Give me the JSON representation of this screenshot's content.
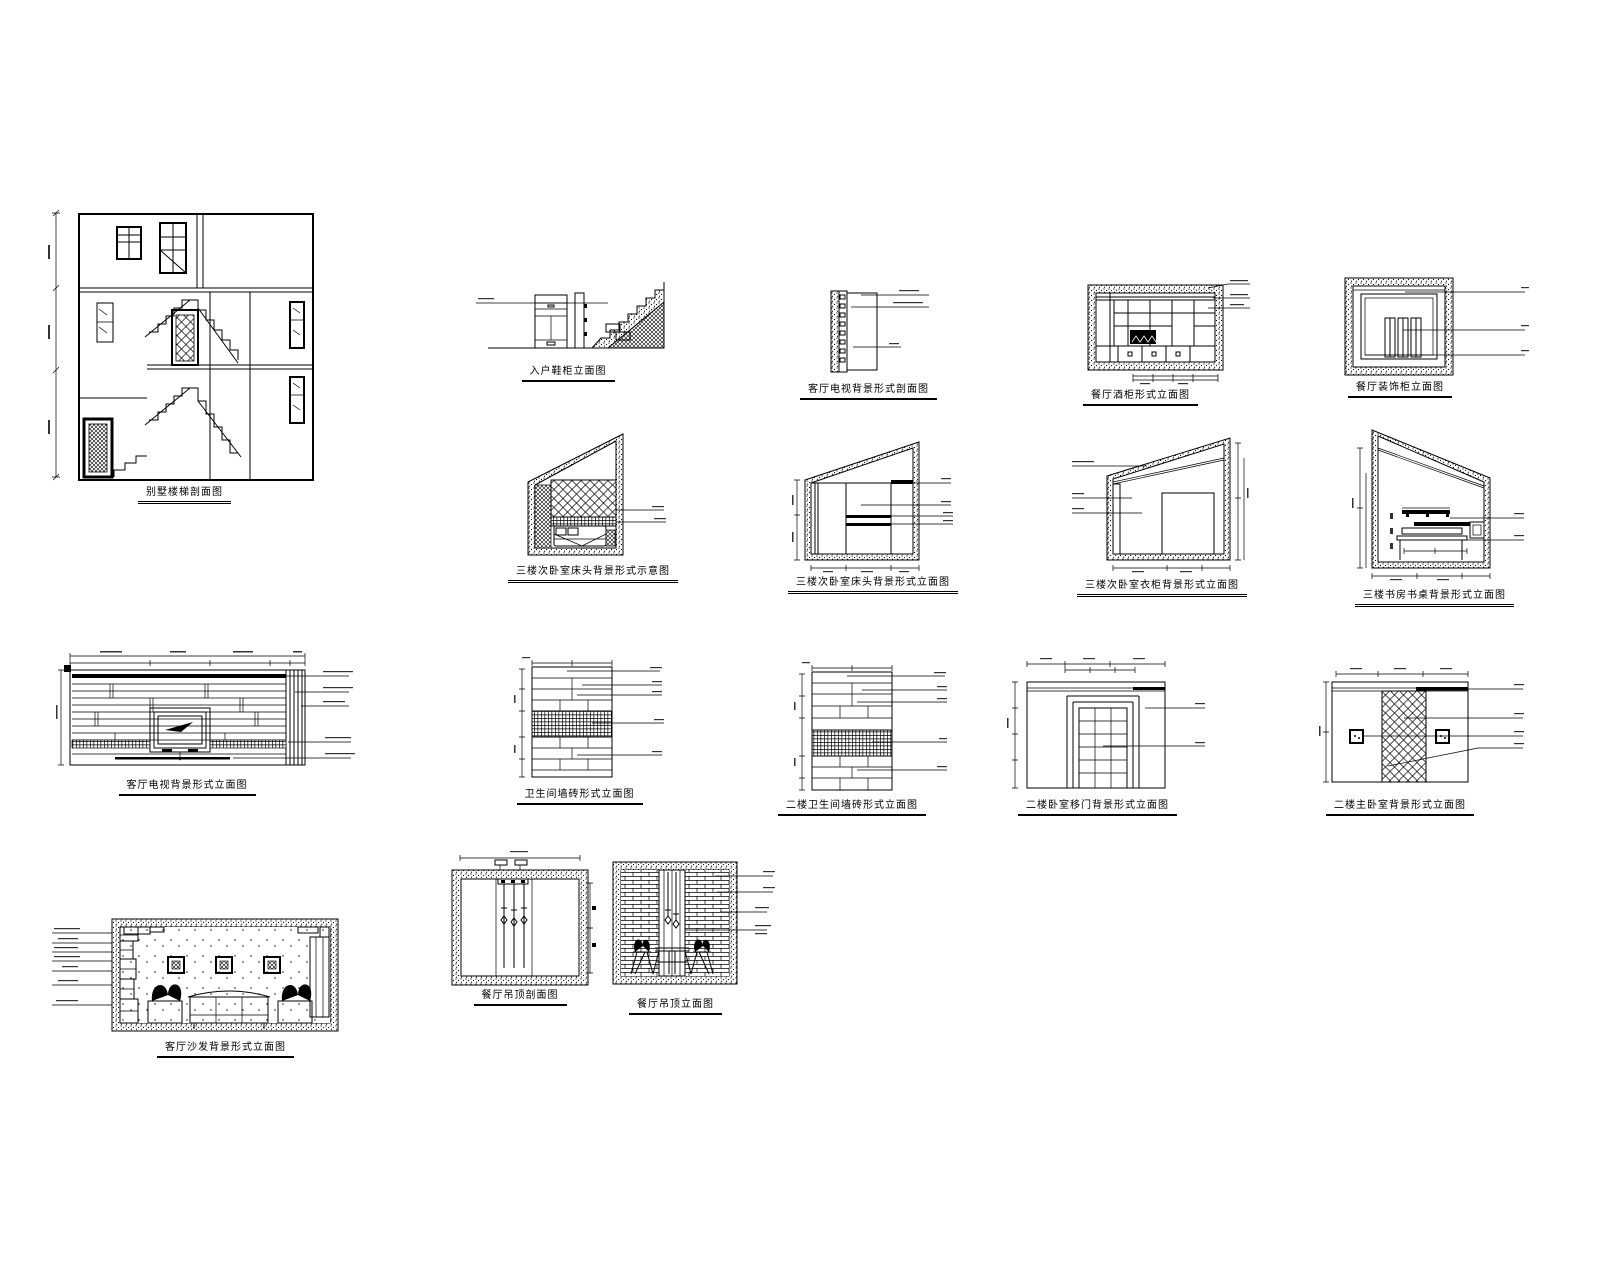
{
  "sheet": {
    "background": "#ffffff",
    "ink": "#000000",
    "description": "CAD interior design elevation sheet"
  },
  "figures": {
    "stair_section": {
      "caption": "别墅楼梯剖面图"
    },
    "entry_cabinet": {
      "caption": "入户鞋柜立面图"
    },
    "tv_wall_section": {
      "caption": "客厅电视背景形式剖面图"
    },
    "wine_cabinet": {
      "caption": "餐厅酒柜形式立面图"
    },
    "deco_cabinet": {
      "caption": "餐厅装饰柜立面图"
    },
    "attic_headboard_sketch": {
      "caption": "三楼次卧室床头背景形式示意图"
    },
    "attic_headboard": {
      "caption": "三楼次卧室床头背景形式立面图"
    },
    "attic_wardrobe": {
      "caption": "三楼次卧室衣柜背景形式立面图"
    },
    "attic_desk": {
      "caption": "三楼书房书桌背景形式立面图"
    },
    "tv_wall": {
      "caption": "客厅电视背景形式立面图"
    },
    "bath_tile_1": {
      "caption": "卫生间墙砖形式立面图"
    },
    "bath_tile_2": {
      "caption": "二楼卫生间墙砖形式立面图"
    },
    "bedroom_door": {
      "caption": "二楼卧室移门背景形式立面图"
    },
    "master_lattice": {
      "caption": "二楼主卧室背景形式立面图"
    },
    "dining_ceiling_section": {
      "caption": "餐厅吊顶剖面图"
    },
    "dining_elevation": {
      "caption": "餐厅吊顶立面图"
    },
    "sofa_wall": {
      "caption": "客厅沙发背景形式立面图"
    }
  }
}
